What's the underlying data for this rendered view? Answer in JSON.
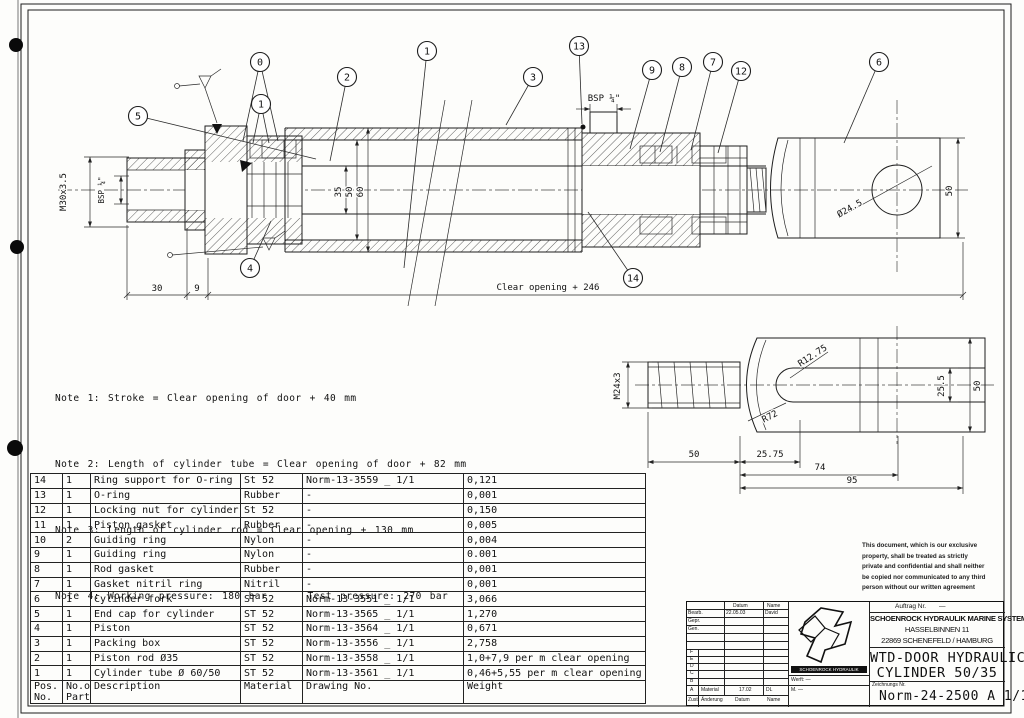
{
  "notes": [
    "Note 1: Stroke = Clear opening of door + 40 mm",
    "Note 2: Length of cylinder tube = Clear opening of door + 82 mm",
    "Note 3: Length of cylinder rod = Clear opening + 130 mm",
    "Note 4: Working pressure: 180 bar     Test pressure: 270 bar"
  ],
  "parts_table": {
    "headers": {
      "pos1": "Pos.",
      "pos2": "No.",
      "qty1": "No.of",
      "qty2": "Parts",
      "desc": "Description",
      "material": "Material",
      "drawing": "Drawing No.",
      "weight": "Weight"
    },
    "rows": [
      {
        "pos": "14",
        "qty": "1",
        "desc": "Ring support for O-ring",
        "material": "St 52",
        "drawing": "Norm-13-3559 _ 1/1",
        "weight": "0,121"
      },
      {
        "pos": "13",
        "qty": "1",
        "desc": "O-ring",
        "material": "Rubber",
        "drawing": "-",
        "weight": "0,001"
      },
      {
        "pos": "12",
        "qty": "1",
        "desc": "Locking nut for cylinder",
        "material": "St 52",
        "drawing": "-",
        "weight": "0,150"
      },
      {
        "pos": "11",
        "qty": "1",
        "desc": "Piston gasket",
        "material": "Rubber",
        "drawing": "-",
        "weight": "0,005"
      },
      {
        "pos": "10",
        "qty": "2",
        "desc": "Guiding ring",
        "material": "Nylon",
        "drawing": "-",
        "weight": "0,004"
      },
      {
        "pos": "9",
        "qty": "1",
        "desc": "Guiding ring",
        "material": "Nylon",
        "drawing": "-",
        "weight": "0.001"
      },
      {
        "pos": "8",
        "qty": "1",
        "desc": "Rod gasket",
        "material": "Rubber",
        "drawing": "-",
        "weight": "0,001"
      },
      {
        "pos": "7",
        "qty": "1",
        "desc": "Gasket nitril ring",
        "material": "Nitril",
        "drawing": "-",
        "weight": "0,001"
      },
      {
        "pos": "6",
        "qty": "1",
        "desc": "Cylinder fork",
        "material": "ST 52",
        "drawing": "Norm-13-3551 _ 1/1",
        "weight": "3,066"
      },
      {
        "pos": "5",
        "qty": "1",
        "desc": "End cap for cylinder",
        "material": "ST 52",
        "drawing": "Norm-13-3565 _ 1/1",
        "weight": "1,270"
      },
      {
        "pos": "4",
        "qty": "1",
        "desc": "Piston",
        "material": "ST 52",
        "drawing": "Norm-13-3564 _ 1/1",
        "weight": "0,671"
      },
      {
        "pos": "3",
        "qty": "1",
        "desc": "Packing box",
        "material": "ST 52",
        "drawing": "Norm-13-3556 _ 1/1",
        "weight": "2,758"
      },
      {
        "pos": "2",
        "qty": "1",
        "desc": "Piston rod Ø35",
        "material": "ST 52",
        "drawing": "Norm-13-3558 _ 1/1",
        "weight": "1,0+7,9 per m clear opening"
      },
      {
        "pos": "1",
        "qty": "1",
        "desc": "Cylinder tube Ø 60/50",
        "material": "ST 52",
        "drawing": "Norm-13-3561 _ 1/1",
        "weight": "0,46+5,55 per m clear opening"
      }
    ]
  },
  "dims": {
    "m30": "M30x3.5",
    "bsp_left": "BSP ¼\"",
    "d30": "30",
    "d9": "9",
    "clear_opening": "Clear opening + 246",
    "d35": "35",
    "d50": "50",
    "d60": "60",
    "bsp_right": "BSP ¼\"",
    "dia_hole": "Ø24.5",
    "d50_fork": "50",
    "m24": "M24x3",
    "r1275": "R12.75",
    "r72": "R72",
    "d255": "25.5",
    "d50_detail": "50",
    "f50": "50",
    "f2575": "25.75",
    "f74": "74",
    "f95": "95"
  },
  "balloons": [
    {
      "label": "5",
      "x": 138,
      "y": 116,
      "leads": [
        [
          316,
          159
        ]
      ]
    },
    {
      "label": "0",
      "x": 260,
      "y": 62,
      "leads": [
        [
          243,
          141
        ],
        [
          278,
          141
        ]
      ]
    },
    {
      "label": "1",
      "x": 261,
      "y": 104,
      "leads": [
        [
          253,
          143
        ],
        [
          269,
          143
        ]
      ]
    },
    {
      "label": "2",
      "x": 347,
      "y": 77,
      "leads": [
        [
          330,
          161
        ]
      ]
    },
    {
      "label": "1",
      "x": 427,
      "y": 51,
      "leads": [
        [
          404,
          268
        ]
      ]
    },
    {
      "label": "3",
      "x": 533,
      "y": 77,
      "leads": [
        [
          506,
          125
        ]
      ]
    },
    {
      "label": "13",
      "x": 579,
      "y": 46,
      "leads": [
        [
          582,
          124
        ]
      ]
    },
    {
      "label": "9",
      "x": 652,
      "y": 70,
      "leads": [
        [
          630,
          149
        ]
      ]
    },
    {
      "label": "8",
      "x": 682,
      "y": 67,
      "leads": [
        [
          660,
          152
        ]
      ]
    },
    {
      "label": "7",
      "x": 713,
      "y": 62,
      "leads": [
        [
          691,
          150
        ]
      ]
    },
    {
      "label": "12",
      "x": 741,
      "y": 71,
      "leads": [
        [
          718,
          153
        ]
      ]
    },
    {
      "label": "6",
      "x": 879,
      "y": 62,
      "leads": [
        [
          844,
          143
        ]
      ]
    },
    {
      "label": "4",
      "x": 250,
      "y": 268,
      "leads": [
        [
          271,
          221
        ]
      ]
    },
    {
      "label": "14",
      "x": 633,
      "y": 278,
      "leads": [
        [
          588,
          212
        ]
      ]
    }
  ],
  "title_block": {
    "auftrag_label": "Auftrag Nr.",
    "auftrag_value": "—",
    "company": [
      "SCHOENROCK HYDRAULIK MARINE SYSTEMS GmbH",
      "HASSELBINNEN 11",
      "22869 SCHENEFELD / HAMBURG"
    ],
    "title": [
      "WTD-DOOR HYDRAULIC",
      "CYLINDER 50/35"
    ],
    "drawing_no_label": "Zeichnungs Nr.",
    "drawing_no": "Norm-24-2500 A 1/1",
    "logo_text": "SCHOENROCK HYDRAULIK",
    "werft": "Werft: —",
    "m_row": "M. —",
    "rev": {
      "datum": "Datum",
      "name": "Name",
      "bearb": "Bearb.",
      "bearb_datum": "22.05.03",
      "bearb_name": "David",
      "gepr": "Gepr.",
      "gen": "Gen.",
      "letters": [
        "F",
        "E",
        "D",
        "C",
        "B"
      ],
      "a": "A",
      "a_label": "Material",
      "a_datum": "17.02",
      "a_name": "DL",
      "zust": "Zust.",
      "aenderung": "Änderung",
      "datum2": "Datum",
      "name2": "Name"
    }
  },
  "disclaimer": [
    "This document, which is our exclusive",
    "property, shall be treated as strictly",
    "private and confidential and shall neither",
    "be copied nor communicated to any third",
    "person without our written agreement"
  ]
}
